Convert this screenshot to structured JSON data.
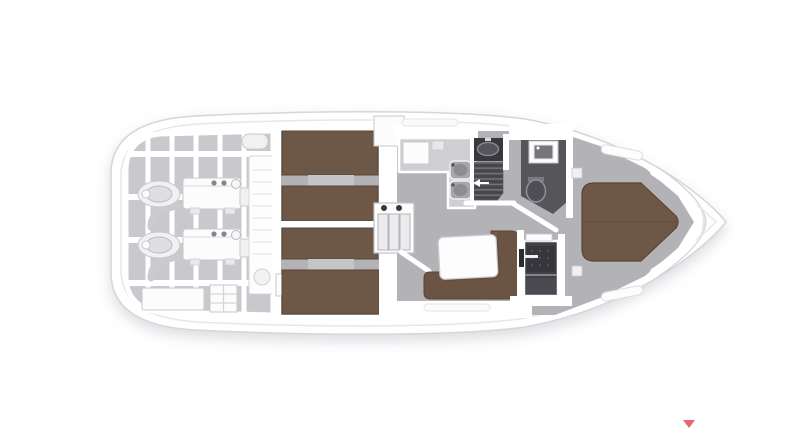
{
  "canvas": {
    "width": 800,
    "height": 446,
    "background": "#ffffff"
  },
  "colors": {
    "hull_fill": "#ffffff",
    "hull_stroke": "#d6d6d8",
    "deck_line": "#e7e7e9",
    "floor_gray": "#b3b3b7",
    "floor_light": "#c9c9cd",
    "counter_gray": "#cfcfd3",
    "wall_white": "#ffffff",
    "berth_brown": "#6d5746",
    "berth_brown_dark": "#5a4635",
    "sofa_brown": "#6b5443",
    "dark_floor": "#55555a",
    "stair_dark": "#46464b",
    "stair_tread": "#73737a",
    "fixture_dark": "#39393d",
    "fixture_gray": "#9a9a9f",
    "marker_red": "#e2696c",
    "shadow": "#9095a0"
  },
  "diagram": {
    "type": "boat-floor-plan",
    "view": "top-down lower deck",
    "regions": [
      "hull",
      "engine-room",
      "port-engine",
      "starboard-engine",
      "companionway-steps",
      "aft-cabin-port",
      "aft-cabin-starboard",
      "louver-cabinet",
      "galley",
      "staircase",
      "day-head",
      "toilet",
      "vanity-sink",
      "dinette",
      "dinette-table",
      "shower-stall",
      "forward-cabin",
      "island-berth",
      "bow-deck"
    ]
  },
  "marker": {
    "icon": "down-triangle",
    "role": "carousel-next-arrow"
  }
}
